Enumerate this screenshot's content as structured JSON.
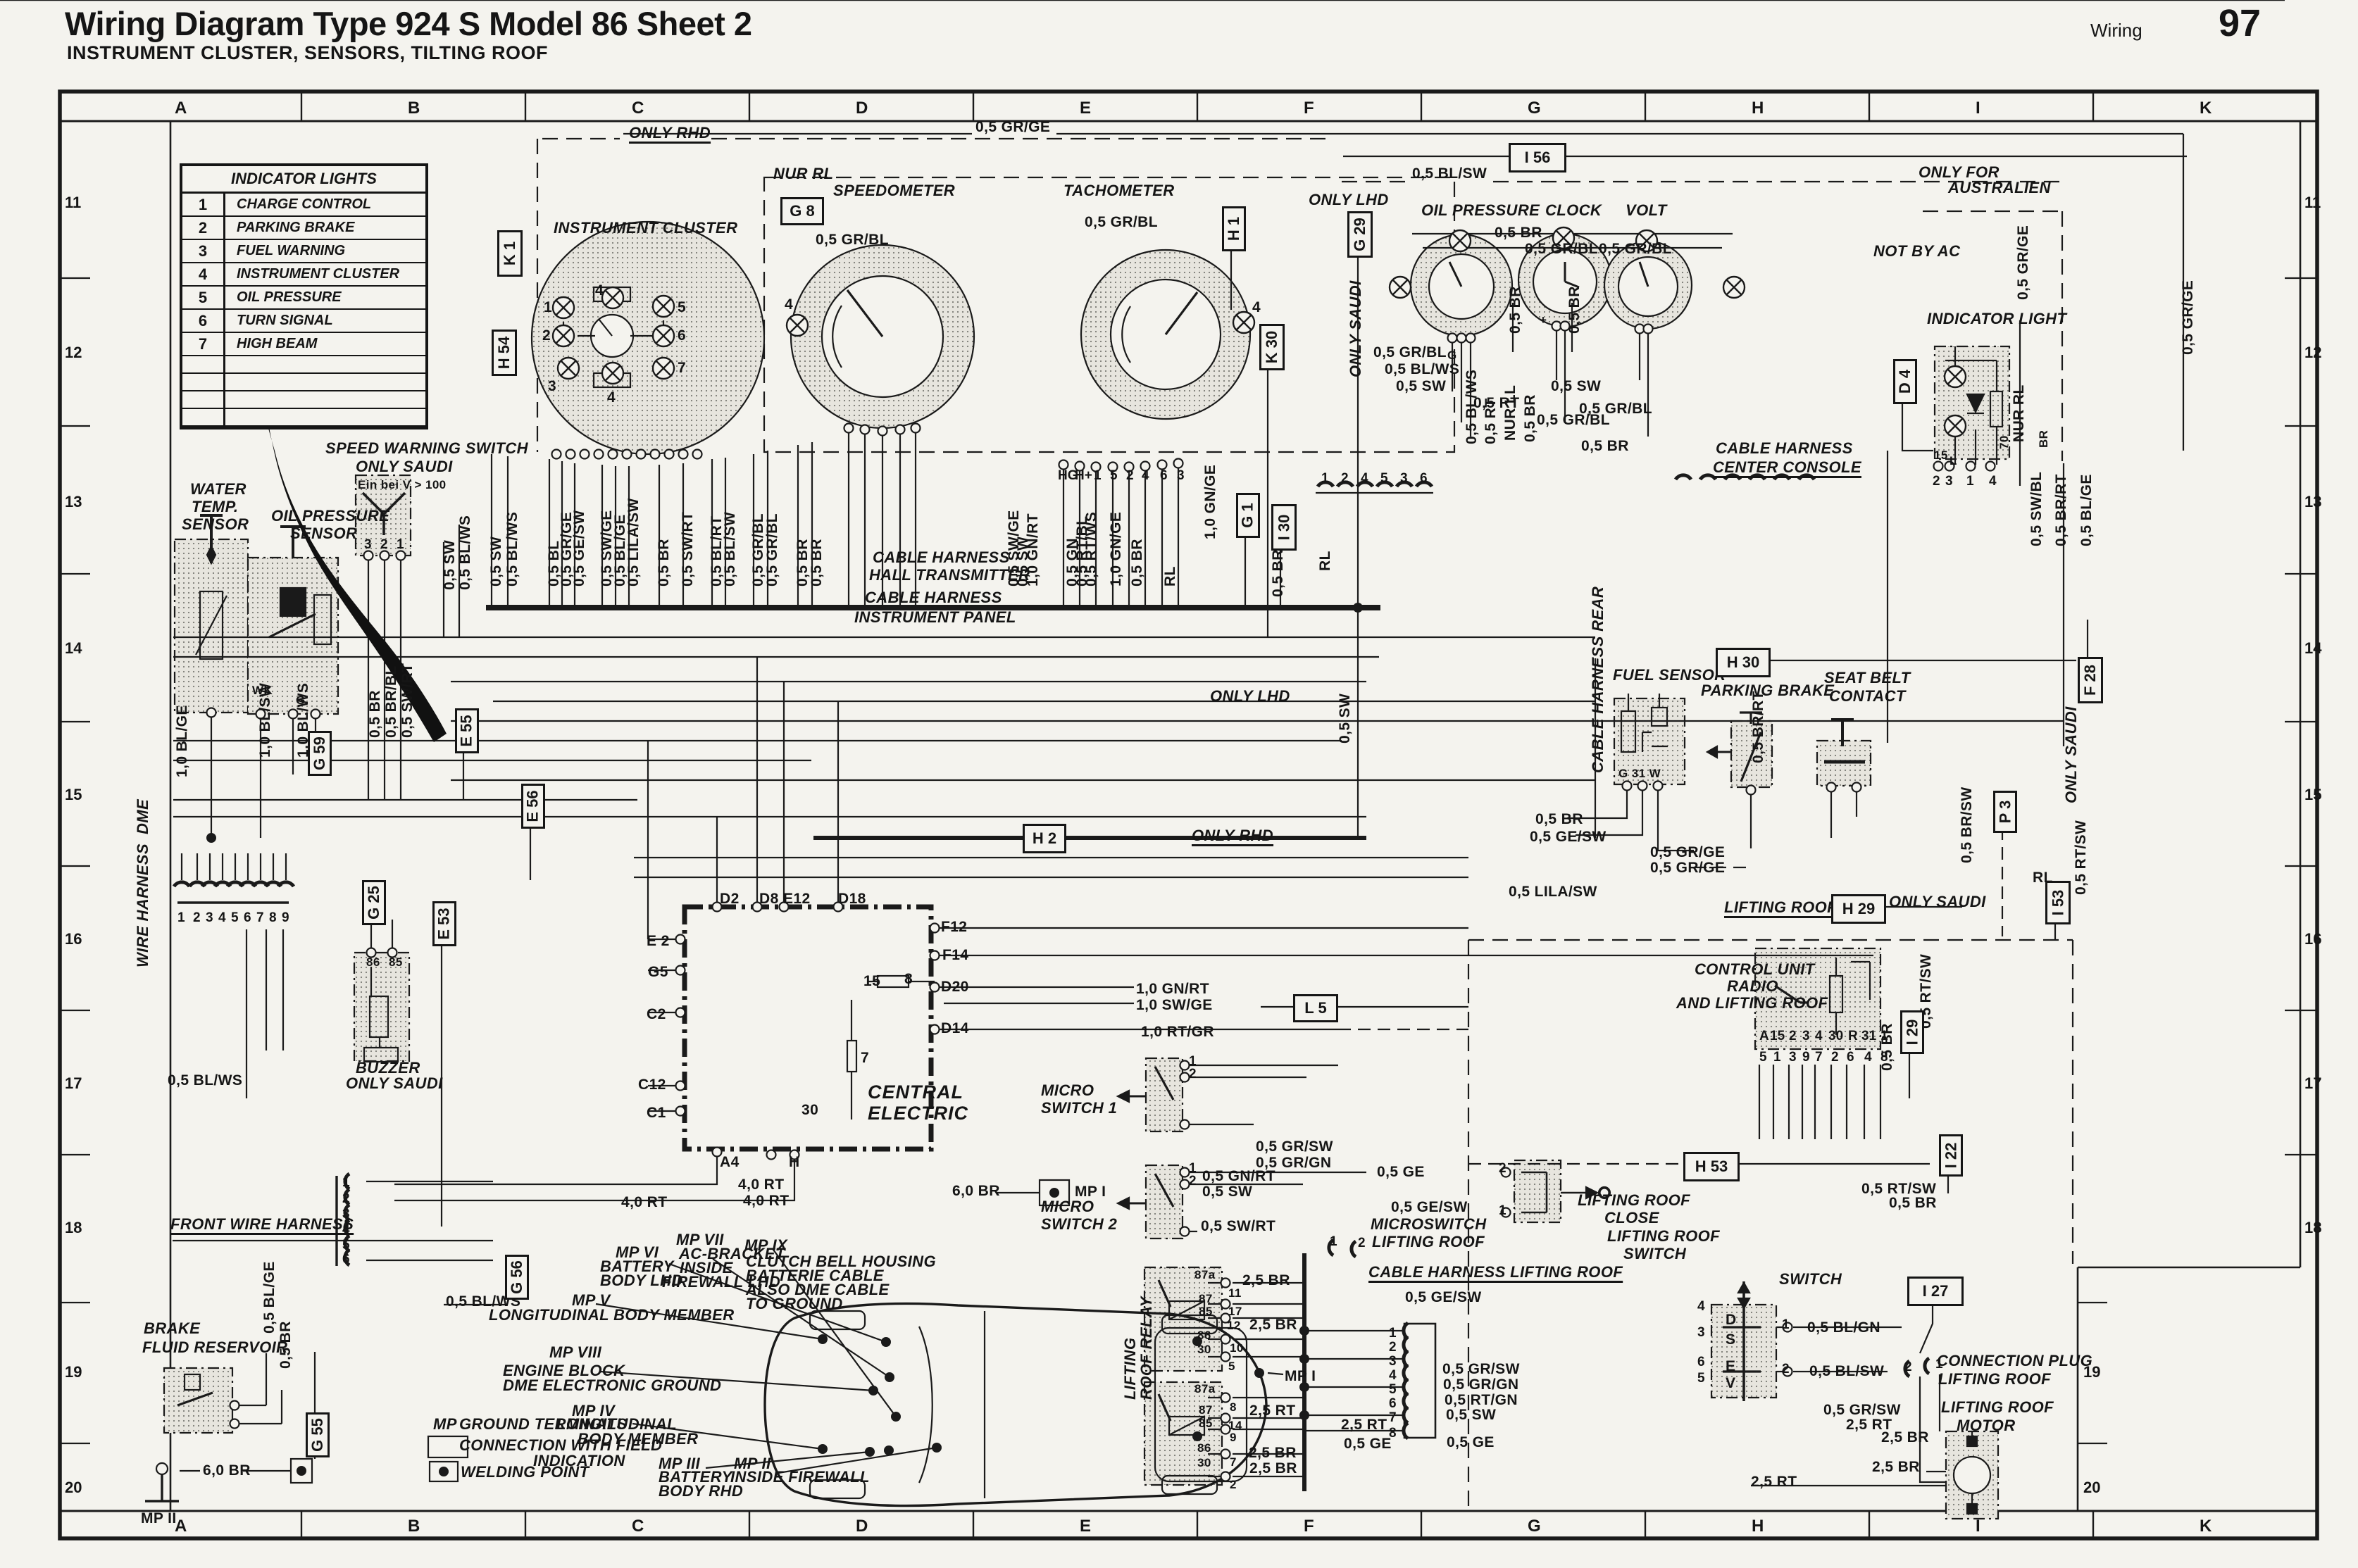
{
  "page": {
    "title": "Wiring Diagram Type 924 S Model 86 Sheet 2",
    "subtitle": "INSTRUMENT CLUSTER, SENSORS, TILTING ROOF",
    "corner_label": "Wiring",
    "page_number": "97"
  },
  "grid": {
    "columns": [
      "A",
      "B",
      "C",
      "D",
      "E",
      "F",
      "G",
      "H",
      "I",
      "K"
    ],
    "rows": [
      "11",
      "12",
      "13",
      "14",
      "15",
      "16",
      "17",
      "18",
      "19",
      "20"
    ]
  },
  "legend": {
    "title": "INDICATOR LIGHTS",
    "rows": [
      {
        "num": "1",
        "label": "CHARGE CONTROL"
      },
      {
        "num": "2",
        "label": "PARKING BRAKE"
      },
      {
        "num": "3",
        "label": "FUEL WARNING"
      },
      {
        "num": "4",
        "label": "INSTRUMENT CLUSTER"
      },
      {
        "num": "5",
        "label": "OIL PRESSURE"
      },
      {
        "num": "6",
        "label": "TURN SIGNAL"
      },
      {
        "num": "7",
        "label": "HIGH BEAM"
      }
    ],
    "empty_rows": 4
  },
  "texts": {
    "only_rhd_top": "ONLY RHD",
    "nur_rl_top": "NUR RL",
    "grge_top": "0,5 GR/GE",
    "blsw_top": "0,5 BL/SW",
    "only_lhd_top": "ONLY LHD",
    "speedometer": "SPEEDOMETER",
    "tachometer": "TACHOMETER",
    "instrument_cluster": "INSTRUMENT CLUSTER",
    "oil_pressure_t": "OIL PRESSURE",
    "clock_t": "CLOCK",
    "volt_t": "VOLT",
    "not_by_ac": "NOT BY AC",
    "only_for": "ONLY FOR",
    "australien": "AUSTRALIEN",
    "indicator_light_t": "INDICATOR LIGHT",
    "grbl_speedo": "0,5 GR/BL",
    "grbl_tach": "0,5 GR/BL",
    "br_gauges": "0,5 BR",
    "grbl_g1": "0,5 GR/BL",
    "grbl_g2": "0,5 GR/BL",
    "br_v1": "0,5 BR",
    "br_v2": "0,5 BR",
    "g_oil": "G",
    "clock_plus": "+",
    "water1": "WATER",
    "water2": "TEMP.",
    "water3": "SENSOR",
    "oil1": "OIL PRESSURE",
    "oil2": "SENSOR",
    "spdw1": "SPEED WARNING SWITCH",
    "spdw2": "ONLY SAUDI",
    "einbei": "Ein bei V > 100",
    "wk": "WK",
    "g_oil2": "G",
    "blge_l": "1,0 BL/GE",
    "blsw_l": "1,0 BL/SW",
    "blws_l": "1,0 BL/WS",
    "br_sw1": "0,5 BR",
    "brbl_sw": "0,5 BR/BL",
    "swrt_sw": "0,5 SW/RT",
    "sw_r1": "0,5 SW",
    "blws_r1": "0,5 BL/WS",
    "whdme": "WIRE HARNESS  DME",
    "cb1": "0,5 SW",
    "cb2": "0,5 BL/WS",
    "cb3": "0,5 BL",
    "cb4": "0,5 GR/GE",
    "cb5": "0,5 GE/SW",
    "cb6": "0,5 SW/GE",
    "cb7": "0,5 BL/GE",
    "cb8": "0,5 LILA/SW",
    "cb9": "0,5 BR",
    "cb10": "0,5 SW/RT",
    "cb11": "0,5 BL/RT",
    "cb12": "0,5 BL/SW",
    "cb13": "0,5 GR/BL",
    "cb14": "0,5 GR/BL",
    "cb15": "0,5 BR",
    "cb16": "0,5 BR",
    "tb1": "0,5 SW/GE",
    "tb2": "0,5 SW",
    "tb3": "1,0 GN/RT",
    "tb4": "0,5 GN",
    "tb5": "0,5 RT/BL",
    "tb6": "0,5 RT/WS",
    "tb7": "1,0 GN/GE",
    "tb8": "0,5 BR",
    "tb9": "RL",
    "gnge_v2": "1,0 GN/GE",
    "br_v3": "0,5 BR",
    "rl_v2": "RL",
    "sw_v3": "0,5 SW",
    "ch1a": "CABLE HARNESS",
    "ch1b": "HALL TRANSMITTER",
    "ch2a": "CABLE HARNESS",
    "ch2b": "INSTRUMENT PANEL",
    "only_lhd_mid": "ONLY LHD",
    "only_rhd_mid": "ONLY RHD",
    "blws_v2": "0,5 BL/WS",
    "rt_v1": "0,5 RT",
    "nurll": "NUR LL",
    "br_v4": "0,5 BR",
    "gb1": "0,5 GR/BL",
    "gb2": "0,5 BL/WS",
    "gb3": "0,5 SW",
    "gb4": "0,5 RT",
    "gb5": "0,5 GR/BL",
    "gb6": "0,5 SW",
    "grbl_c": "0,5 GR/BL",
    "br_c": "0,5 BR",
    "chc1": "CABLE HARNESS",
    "chc2": "CENTER CONSOLE",
    "grge_v1": "0,5 GR/GE",
    "grge_v2r": "0,5 GR/GE",
    "nurrl_v": "NUR RL",
    "swbl_v": "0,5 SW/BL",
    "brrt_v": "0,5 BR/RT",
    "blge_v2": "0,5 BL/GE",
    "ind15": "15",
    "indL": "L",
    "ind70": "70",
    "indBR": "BR",
    "chrear": "CABLE HARNESS REAR",
    "fuel_t": "FUEL SENSOR",
    "g31w": "G 31 W",
    "park_t": "PARKING BRAKE",
    "seat1": "SEAT BELT",
    "seat2": "CONTACT",
    "brrt_v2": "0,5 BR/RT",
    "brsw_v": "0,5 BR/SW",
    "br_f": "0,5 BR",
    "gesw_f": "0,5 GE/SW",
    "grge_p1": "0,5 GR/GE",
    "grge_p2": "0,5 GR/GE",
    "lilasw": "0,5 LILA/SW",
    "rl_d": "RL",
    "rtsw_v1": "0,5 RT/SW",
    "onlysaudi_v1": "ONLY SAUDI",
    "onlysaudi_h29": "ONLY SAUDI",
    "onlysaudi_g29": "ONLY SAUDI",
    "lr_head": "LIFTING ROOF",
    "buz1": "BUZZER",
    "buz2": "ONLY SAUDI",
    "b86": "86",
    "b85": "85",
    "ce1": "CENTRAL",
    "ce2": "ELECTRIC",
    "ceD2": "D2",
    "ceD8": "D8",
    "ceE12": "E12",
    "ceD18": "D18",
    "ceF12": "F12",
    "ceF14": "F14",
    "ceD20": "D20",
    "ceD14": "D14",
    "ceE2": "E 2",
    "ceG5": "G5",
    "ceC2": "C2",
    "ceC12": "C12",
    "ceC1": "C1",
    "ceA4": "A4",
    "ceH": "H",
    "ce15": "15",
    "ce8": "8",
    "ce7": "7",
    "ce30": "30",
    "rt40a": "4,0 RT",
    "rt40b": "4,0 RT",
    "rt40c": "4,0 RT",
    "ms1a": "MICRO",
    "ms1b": "SWITCH 1",
    "ms2a": "MICRO",
    "ms2b": "SWITCH 2",
    "gnrt10": "1,0 GN/RT",
    "swge10": "1,0 SW/GE",
    "rtgr10": "1,0 RT/GR",
    "grsw_m": "0,5 GR/SW",
    "grgn_m": "0,5 GR/GN",
    "gnrt_m": "0,5 GN/RT",
    "sw_m": "0,5 SW",
    "swrt_m": "0,5 SW/RT",
    "ge_m": "0,5 GE",
    "gesw_m1": "0,5 GE/SW",
    "mswlr1": "MICROSWITCH",
    "mswlr2": "LIFTING ROOF",
    "chlr": "CABLE HARNESS LIFTING ROOF",
    "gesw_m2": "0,5 GE/SW",
    "lrc1": "LIFTING ROOF",
    "lrc2": "CLOSE",
    "lrs1": "LIFTING ROOF",
    "lrs2": "SWITCH",
    "switch_t": "SWITCH",
    "swD": "D",
    "swS": "S",
    "swE": "E",
    "swV": "V",
    "cu1": "CONTROL UNIT",
    "cu2": "RADIO",
    "cu3": "AND LIFTING ROOF",
    "br_cu": "0,5 BR",
    "rtsw_cu": "0,5 RT/SW",
    "rtsw_b": "0,5 RT/SW",
    "br_b": "0,5 BR",
    "lrr1": "LIFTING",
    "lrr2": "ROOF RELAY",
    "r1_87a": "87a",
    "r1_87": "87",
    "r1_85": "85",
    "r1_86": "86",
    "r1_30": "30",
    "p11": "11",
    "p17": "17",
    "p12": "12",
    "p10": "10",
    "p5": "5",
    "r2_87a": "87a",
    "r2_87": "87",
    "r2_85": "85",
    "r2_86": "86",
    "r2_30": "30",
    "p8": "8",
    "p14": "14",
    "p9": "9",
    "p7": "7",
    "p2": "2",
    "br25_1": "2,5 BR",
    "br25_2": "2,5 BR",
    "rt25_1": "2,5 RT",
    "br25_3": "2,5 BR",
    "br25_4": "2,5 BR",
    "rt25_2": "2,5 RT",
    "ge05": "0,5 GE",
    "lc1": "0,5 GR/SW",
    "lc2": "0,5 GR/GN",
    "lc3": "0,5 RT/GN",
    "lc4": "0,5 SW",
    "lc5": "0,5 GE",
    "blgn": "0,5 BL/GN",
    "blsw_s": "0,5 BL/SW",
    "grsw_b": "0,5 GR/SW",
    "rt25_3": "2,5 RT",
    "br25_5": "2,5 BR",
    "br25_6": "2,5 BR",
    "rt25_4": "2,5 RT",
    "cp1": "CONNECTION PLUG",
    "cp2": "LIFTING ROOF",
    "lm1": "LIFTING ROOF",
    "lm2": "MOTOR",
    "fwh": "FRONT WIRE HARNESS",
    "brk1": "BRAKE",
    "brk2": "FLUID RESERVOIR",
    "blge_b": "0,5 BL/GE",
    "br_bb": "0,5 BR",
    "blws_b": "0,5 BL/WS",
    "blws_b2": "0,5 BL/WS",
    "br60a": "6,0 BR",
    "br60b": "6,0 BR",
    "mp1a": "MP I",
    "mp1b": "MP I",
    "mp2b": "MP II",
    "gl_mp": "MP",
    "gl_gt": "GROUND TERMINALS",
    "gl_cf": "CONNECTION WITH FIELD",
    "gl_in": "INDICATION",
    "gl_wp": "WELDING POINT",
    "mp7_1": "MP VII",
    "mp7_2": "AC-BRACKET",
    "mp7_3": "INSIDE",
    "mp7_4": "FIREWALL LHD",
    "mp6_1": "MP VI",
    "mp6_2": "BATTERY",
    "mp6_3": "BODY LHD",
    "mp9_1": "MP IX",
    "mp9_2": "CLUTCH BELL HOUSING",
    "mp9_3": "BATTERIE CABLE",
    "mp9_4": "ALSO DME CABLE",
    "mp9_5": "TO GROUND",
    "mp5_1": "MP V",
    "mp5_2": "LONGITUDINAL BODY MEMBER",
    "mp8_1": "MP VIII",
    "mp8_2": "ENGINE BLOCK",
    "mp8_3": "DME ELECTRONIC GROUND",
    "mp4_1": "MP IV",
    "mp4_2": "LONGITUDINAL",
    "mp4_3": "BODY MEMBER",
    "mp3_1": "MP III",
    "mp3_2": "BATTERY",
    "mp3_3": "BODY RHD",
    "mp2c_1": "MP II",
    "mp2c_2": "INSIDE FIREWALL",
    "cn1": "1",
    "cn2": "2",
    "cn3": "3",
    "cn4": "4",
    "cn5": "5",
    "cn6": "6",
    "cn7": "7",
    "cn4b": "4",
    "spd4": "4",
    "tach4": "4"
  },
  "ref_boxes": {
    "k1": "K 1",
    "h54": "H 54",
    "g8": "G 8",
    "i56": "I 56",
    "g29": "G 29",
    "h1": "H 1",
    "k30": "K 30",
    "g1": "G 1",
    "i30": "I 30",
    "d4": "D 4",
    "f28": "F 28",
    "h30": "H 30",
    "h2": "H 2",
    "g59": "G 59",
    "g25": "G 25",
    "e53": "E 53",
    "e55": "E 55",
    "e56": "E 56",
    "g56": "G 56",
    "g55": "G 55",
    "l5": "L 5",
    "h29": "H 29",
    "i53": "I 53",
    "p3": "P 3",
    "i29": "I 29",
    "i22": "I 22",
    "h53": "H 53",
    "i27": "I 27"
  },
  "pins": {
    "tach": [
      "HG",
      "H+",
      "1",
      "5",
      "2",
      "4",
      "6",
      "3"
    ],
    "console": [
      "1",
      "2",
      "4",
      "5",
      "3",
      "6"
    ],
    "speed_warning": [
      "3",
      "2",
      "1"
    ],
    "dme": [
      "1",
      "2",
      "3",
      "4",
      "5",
      "6",
      "7",
      "8",
      "9"
    ],
    "control_unit_terminals": [
      "A",
      "15",
      "2",
      "3",
      "4",
      "30",
      "R",
      "31",
      "1"
    ],
    "control_unit_pins": [
      "5",
      "1",
      "3",
      "9",
      "7",
      "2",
      "6",
      "4",
      "8"
    ],
    "lifting_roof_connector": [
      "1",
      "2",
      "3",
      "4",
      "5",
      "6",
      "7",
      "8"
    ],
    "front_harness": [
      "1",
      "2",
      "3",
      "4",
      "5",
      "6"
    ],
    "switch_left": [
      "4",
      "3",
      "6",
      "5"
    ],
    "switch_right": [
      "1",
      "2"
    ],
    "micro_switch_1": [
      "1",
      "2"
    ],
    "micro_switch_2": [
      "1",
      "2"
    ],
    "microswitch_lifting_roof": [
      "1",
      "2"
    ],
    "lifting_roof_close": [
      "2",
      "1"
    ],
    "connection_plug": [
      "2",
      "1"
    ],
    "indicator_pins": [
      "2",
      "3",
      "1",
      "4"
    ]
  }
}
